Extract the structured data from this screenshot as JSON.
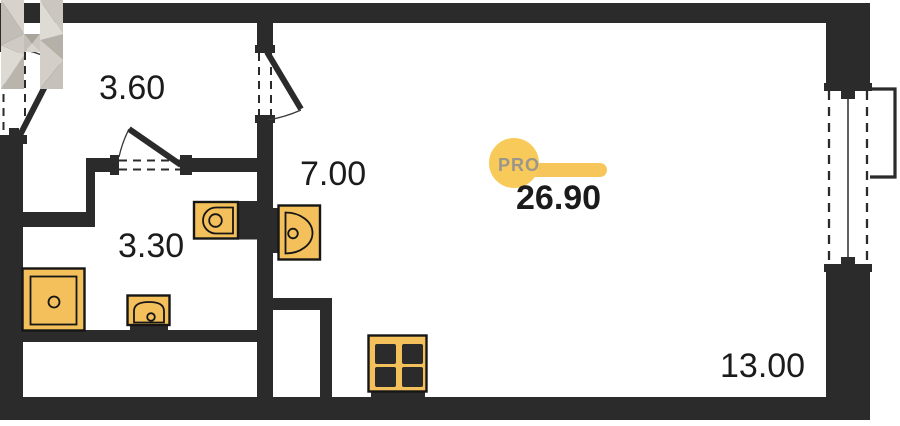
{
  "floor_plan": {
    "total_area": "26.90",
    "logo": {
      "letter": "H",
      "badge_label": "PRO"
    },
    "rooms": [
      {
        "name": "hallway",
        "area": "3.60"
      },
      {
        "name": "bathroom",
        "area": "3.30"
      },
      {
        "name": "kitchen-entry",
        "area": "7.00"
      },
      {
        "name": "living-room",
        "area": "13.00"
      }
    ],
    "fixtures": [
      "shower",
      "washbasin",
      "toilet",
      "kitchen-sink",
      "stove"
    ],
    "features": [
      "entry-door",
      "bathroom-door",
      "room-door",
      "window",
      "balcony",
      "duct-shaft"
    ],
    "colors": {
      "wall": "#2b2b2b",
      "fixture_fill": "#f3c05b",
      "fixture_stroke": "#161616",
      "accent": "#f6c65a",
      "accent_light": "#f8ca5a",
      "badge_text": "#9b958c",
      "text": "#1b1b1b",
      "bg": "#ffffff"
    }
  }
}
